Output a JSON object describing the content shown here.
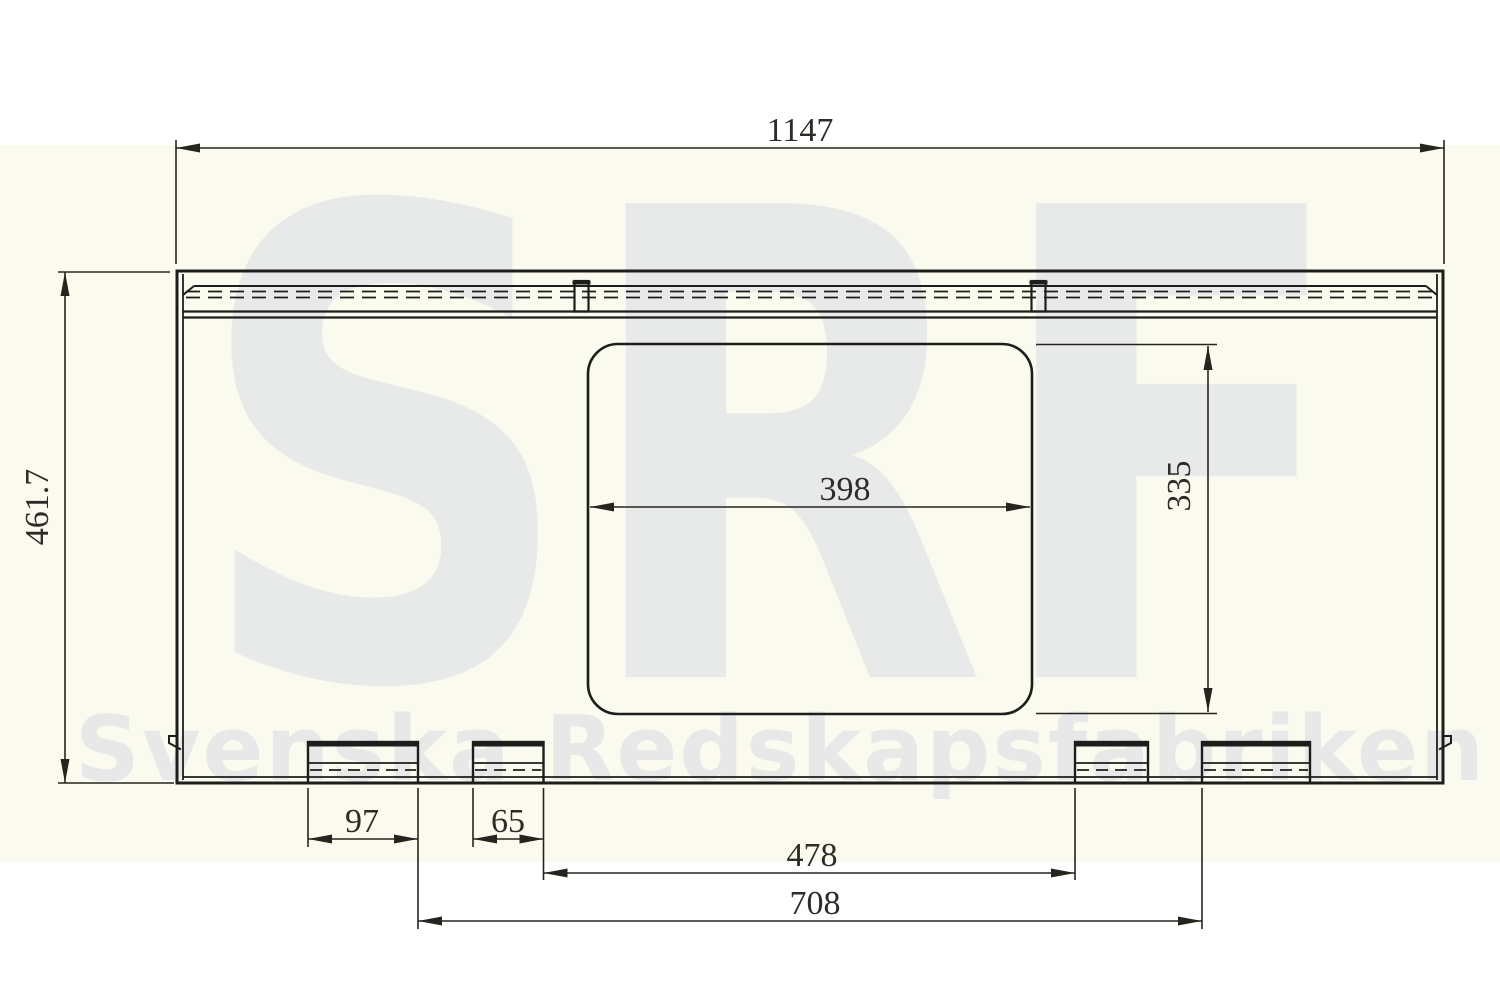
{
  "watermark": {
    "logo_text": "SRF",
    "company_text": "Svenska Redskapsfabriken"
  },
  "dimensions_mm": {
    "overall_width": "1147",
    "overall_height": "461.7",
    "opening_width": "398",
    "opening_height": "335",
    "outer_tab_width": "97",
    "inner_tab_width": "65",
    "inner_tab_spacing": "478",
    "outer_tab_spacing": "708"
  },
  "colors": {
    "line": "#1d1d1b",
    "dimension_text": "#2e2c28",
    "background_band": "#fafaee",
    "watermark_gray": "#e8e9e9",
    "page": "#ffffff"
  }
}
